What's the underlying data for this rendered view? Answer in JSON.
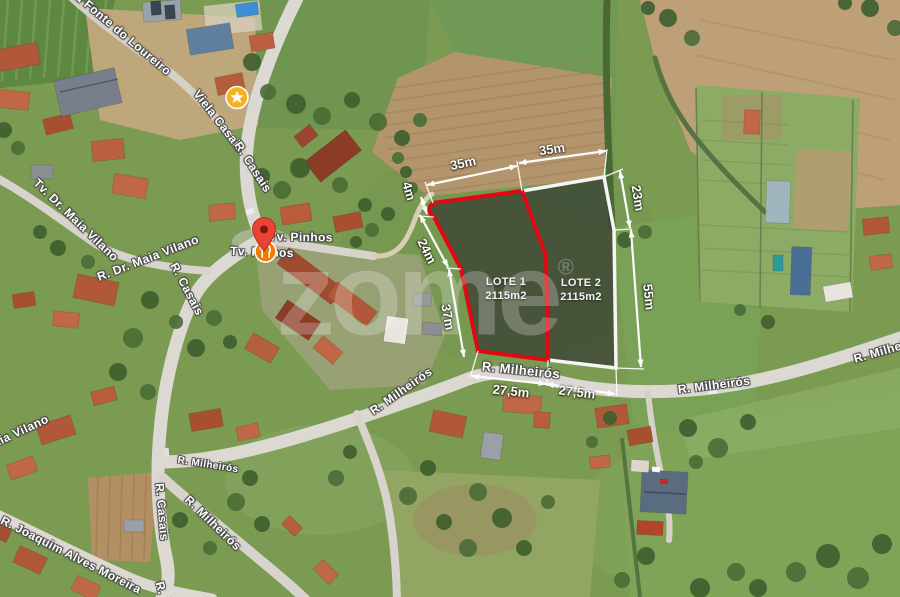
{
  "watermark": {
    "text": "zome",
    "reg": "®"
  },
  "lots": [
    {
      "name": "LOTE 1",
      "area": "2115m2",
      "outline_color": "#e30613"
    },
    {
      "name": "LOTE 2",
      "area": "2115m2",
      "outline_color": "#f5f5f5"
    }
  ],
  "dims": {
    "top_left": "35m",
    "top_right": "35m",
    "right_upper": "23m",
    "right_lower": "55m",
    "left_upper": "24m",
    "left_lower": "37m",
    "corner": "4m",
    "bottom_left": "27,5m",
    "bottom_right": "27,5m"
  },
  "streets": [
    {
      "label": "la Fonte do Loureiro"
    },
    {
      "label": "Viela Casais"
    },
    {
      "label": "R. Casais"
    },
    {
      "label": "Tv. Dr. Maia Vilano"
    },
    {
      "label": "R. Dr. Maia Vilano"
    },
    {
      "label": "R. Casais"
    },
    {
      "label": "Maia Vilano"
    },
    {
      "label": "R. Joaquim Alves Moreira"
    },
    {
      "label": "R. Casais"
    },
    {
      "label": "R."
    },
    {
      "label": "R. Milheirós"
    },
    {
      "label": "R. Milheirós"
    },
    {
      "label": "R. Milheirós"
    },
    {
      "label": "R. Milheirós"
    },
    {
      "label": "R. Milheirós"
    },
    {
      "label": "R. Milheirós"
    },
    {
      "label": "Tv. Pinhos"
    },
    {
      "label": "Tv. Pinhos"
    }
  ],
  "markers": {
    "pin_icon": "map-pin-icon",
    "star_icon": "star-icon",
    "restaurant_icon": "restaurant-icon",
    "pin_color": "#e94335",
    "star_color": "#f9b122",
    "restaurant_color": "#ef7c00"
  },
  "colors": {
    "overlay_fill": "rgba(52,58,50,0.72)",
    "dimension_lines": "#ffffff",
    "road": "#dcd8d2",
    "field_green": "#7b9a52",
    "field_tan": "#b3956c",
    "roof_terracotta": "#b05839"
  }
}
